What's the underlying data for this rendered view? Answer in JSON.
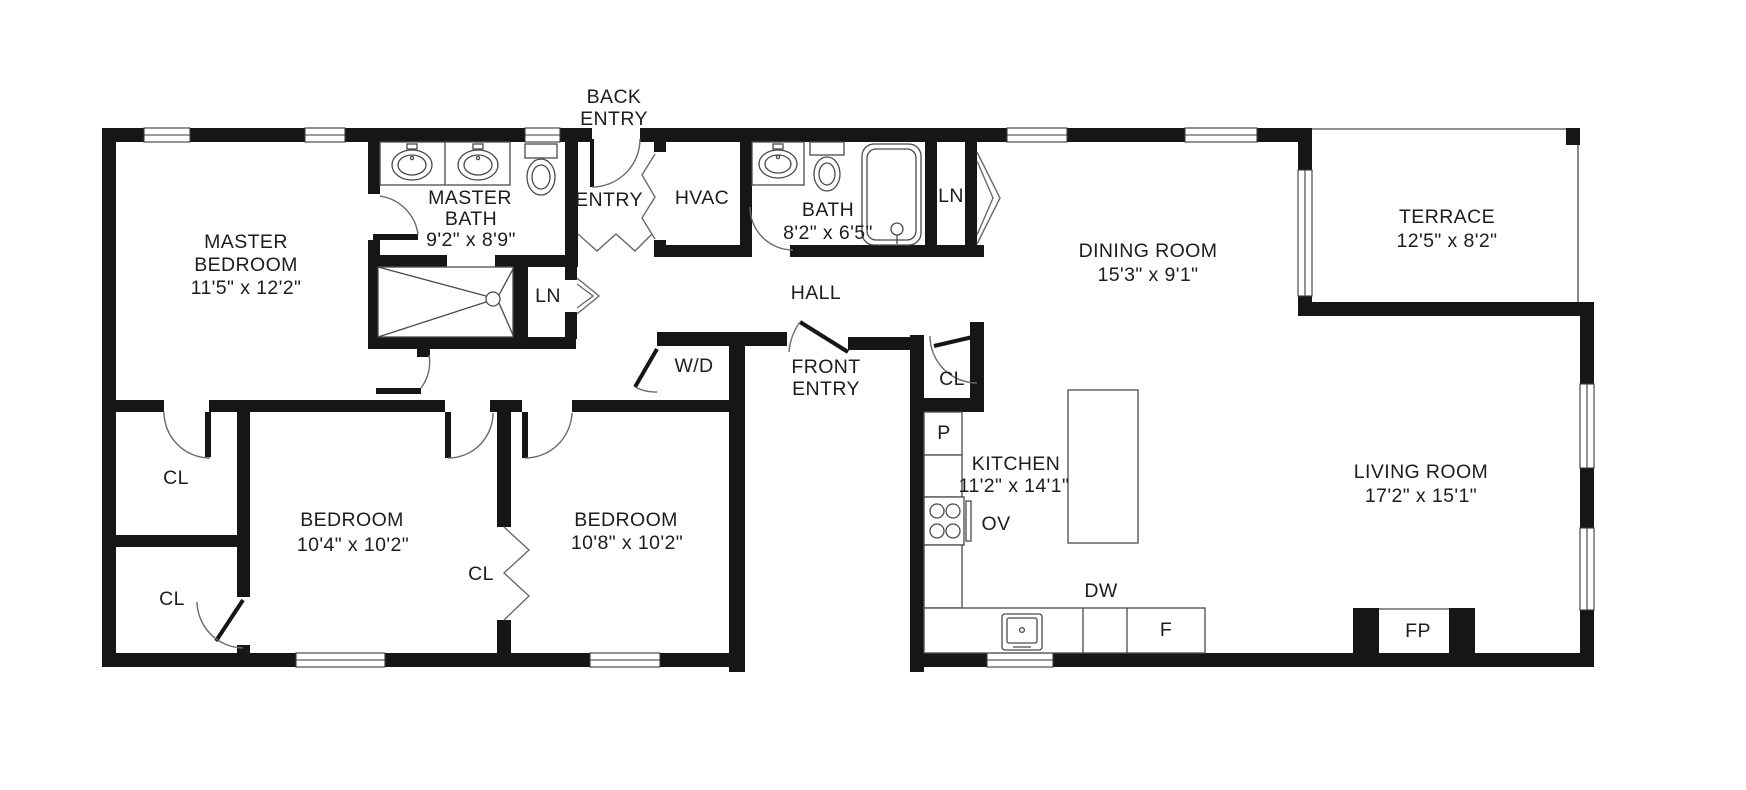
{
  "plan_title": "Single-storey house floor plan",
  "colors": {
    "wall": "#161616",
    "thin_line": "#4a4a4a",
    "text": "#1d1d1d",
    "background": "#ffffff"
  },
  "rooms": [
    {
      "id": "master-bedroom",
      "name_lines": [
        "MASTER",
        "BEDROOM"
      ],
      "dims": "11'5\" x 12'2\""
    },
    {
      "id": "master-bath",
      "name_lines": [
        "MASTER",
        "BATH"
      ],
      "dims": "9'2\" x 8'9\""
    },
    {
      "id": "bath",
      "name_lines": [
        "BATH"
      ],
      "dims": "8'2\" x 6'5\""
    },
    {
      "id": "dining-room",
      "name_lines": [
        "DINING ROOM"
      ],
      "dims": "15'3\" x 9'1\""
    },
    {
      "id": "terrace",
      "name_lines": [
        "TERRACE"
      ],
      "dims": "12'5\" x 8'2\""
    },
    {
      "id": "kitchen",
      "name_lines": [
        "KITCHEN"
      ],
      "dims": "11'2\" x 14'1\""
    },
    {
      "id": "bedroom-1",
      "name_lines": [
        "BEDROOM"
      ],
      "dims": "10'4\" x 10'2\""
    },
    {
      "id": "bedroom-2",
      "name_lines": [
        "BEDROOM"
      ],
      "dims": "10'8\" x 10'2\""
    },
    {
      "id": "living-room",
      "name_lines": [
        "LIVING ROOM"
      ],
      "dims": "17'2\" x 15'1\""
    },
    {
      "id": "hall",
      "name_lines": [
        "HALL"
      ]
    },
    {
      "id": "hvac",
      "name_lines": [
        "HVAC"
      ]
    },
    {
      "id": "entry",
      "name_lines": [
        "ENTRY"
      ]
    },
    {
      "id": "back-entry",
      "name_lines": [
        "BACK",
        "ENTRY"
      ]
    },
    {
      "id": "front-entry",
      "name_lines": [
        "FRONT",
        "ENTRY"
      ]
    }
  ],
  "closets": {
    "linen_top": "LN",
    "linen_lower": "LN",
    "hall_closet": "CL",
    "corridor_closet": "CL",
    "bedroom1_closet": "CL",
    "bedroom2_closet": "CL",
    "washer_dryer": "W/D",
    "pantry": "P"
  },
  "appliances": {
    "oven": "OV",
    "dishwasher": "DW",
    "fridge": "F",
    "fireplace": "FP"
  }
}
